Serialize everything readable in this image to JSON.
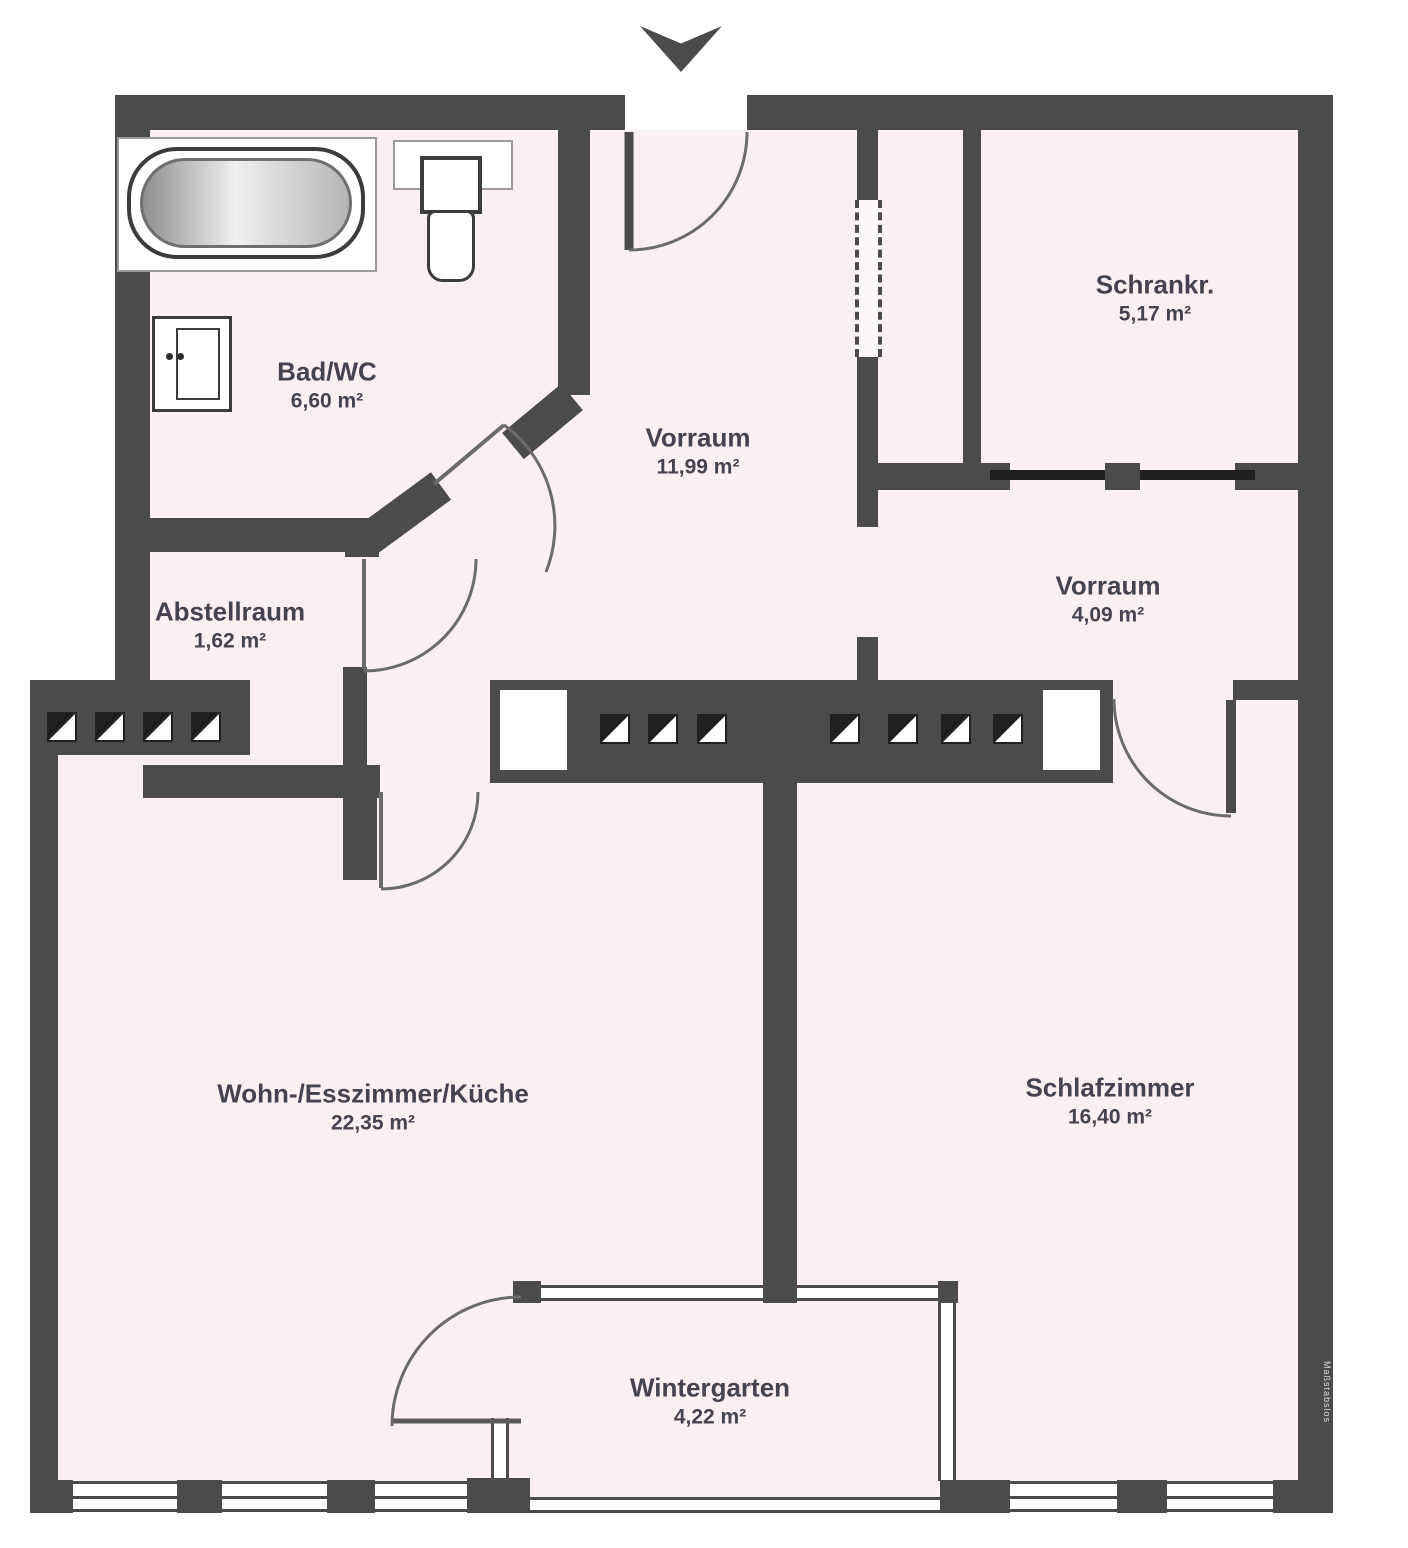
{
  "floorplan": {
    "rooms": [
      {
        "name": "Bad/WC",
        "area": "6,60 m²"
      },
      {
        "name": "Vorraum",
        "area": "11,99 m²"
      },
      {
        "name": "Schrankr.",
        "area": "5,17 m²"
      },
      {
        "name": "Vorraum",
        "area": "4,09 m²"
      },
      {
        "name": "Abstellraum",
        "area": "1,62 m²"
      },
      {
        "name": "Wohn-/Esszimmer/Küche",
        "area": "22,35 m²"
      },
      {
        "name": "Schlafzimmer",
        "area": "16,40 m²"
      },
      {
        "name": "Wintergarten",
        "area": "4,22 m²"
      }
    ],
    "watermark": "Maßstabslos",
    "colors": {
      "wall": "#4b4a4c",
      "floor": "#faf0f2",
      "label": "#45434f"
    }
  }
}
